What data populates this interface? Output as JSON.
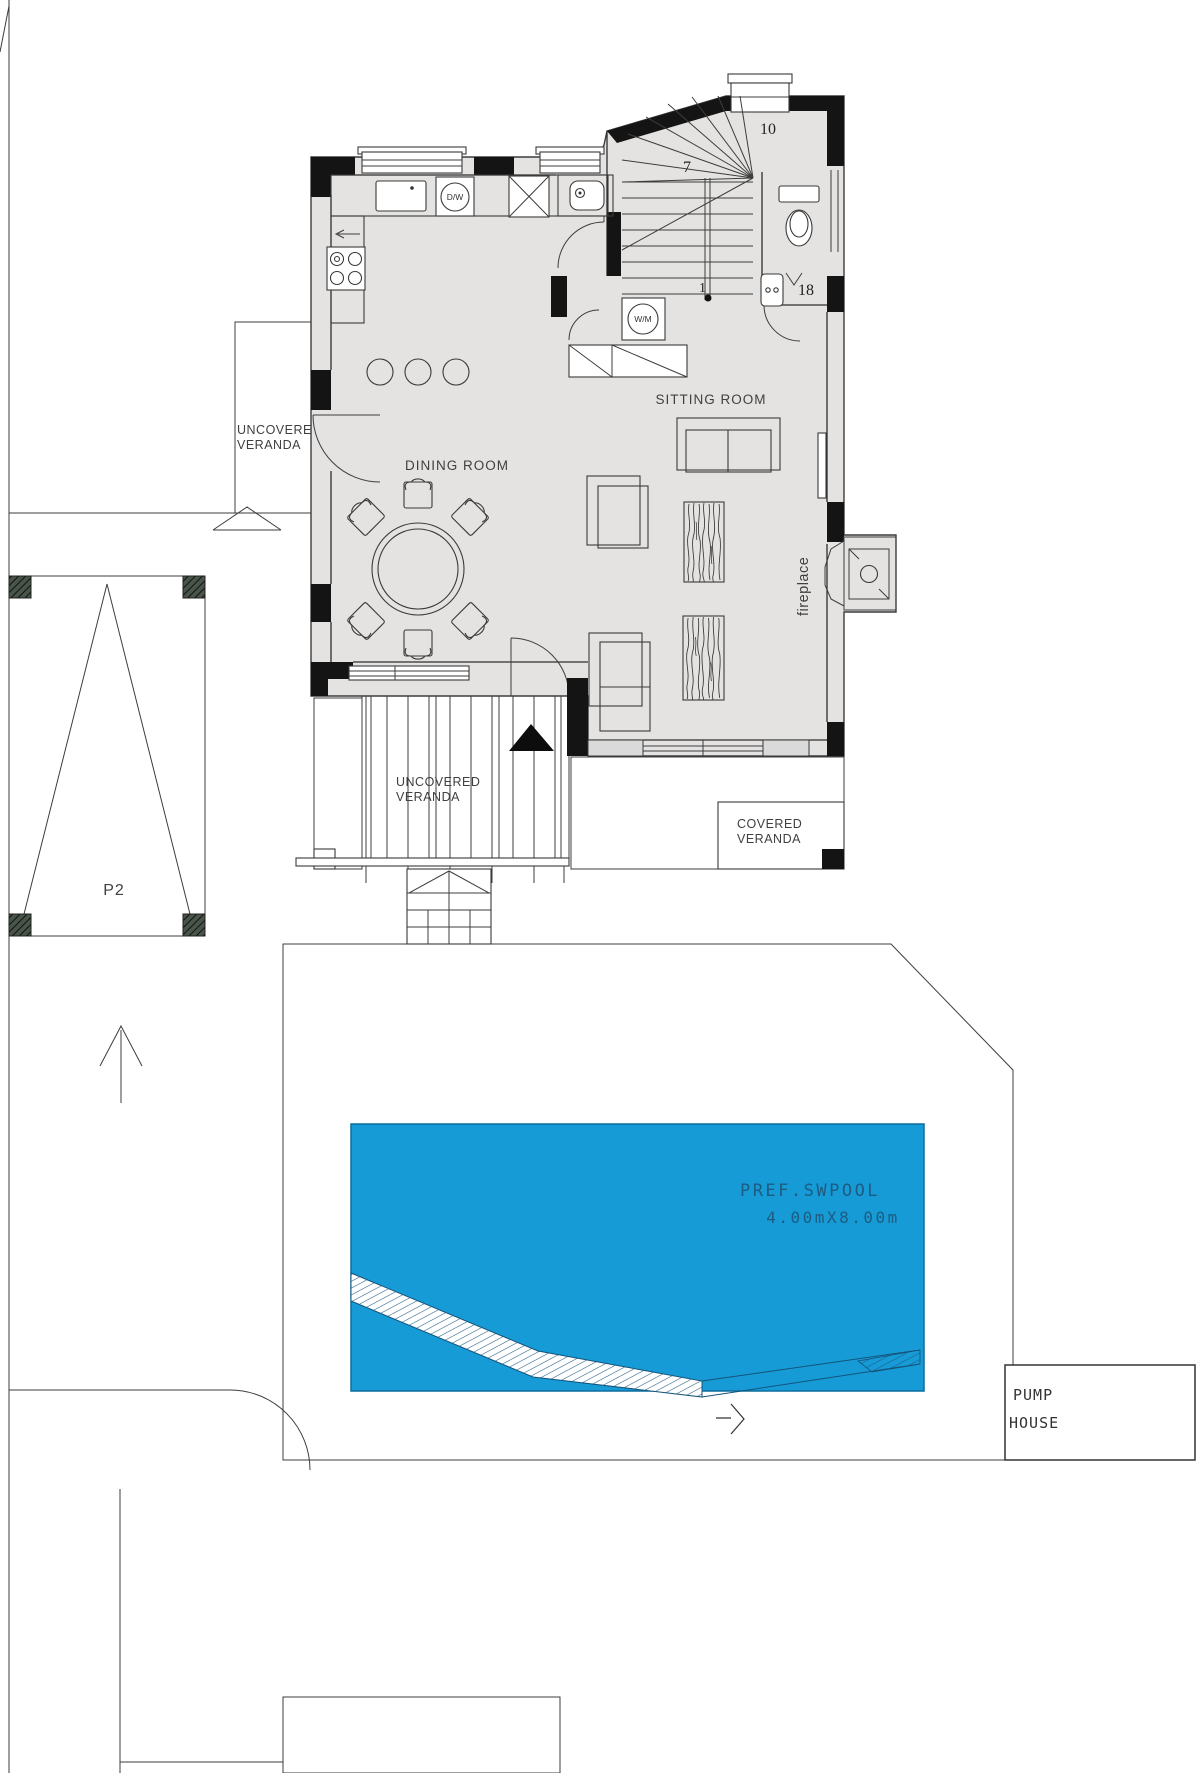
{
  "labels": {
    "veranda_left_line1": "UNCOVERED",
    "veranda_left_line2": "VERANDA",
    "veranda_bottom_line1": "UNCOVERED",
    "veranda_bottom_line2": "VERANDA",
    "covered_line1": "COVERED",
    "covered_line2": "VERANDA",
    "dining": "DINING ROOM",
    "sitting": "SITTING ROOM",
    "fireplace": "fireplace",
    "parking": "P2",
    "pool_line1": "PREF.SWPOOL",
    "pool_line2": "4.00mX8.00m",
    "pump_line1": "PUMP",
    "pump_line2": "HOUSE",
    "dishwasher": "D/W",
    "washing_machine": "W/M",
    "stair_1": "1",
    "stair_7": "7",
    "stair_10": "10",
    "stair_13": "13",
    "stair_18": "18"
  },
  "colors": {
    "pool": "#169BD7",
    "pool_text": "#1D5C80",
    "floor": "#E4E3E2",
    "wall": "#141414",
    "line": "#3D3D3D"
  }
}
